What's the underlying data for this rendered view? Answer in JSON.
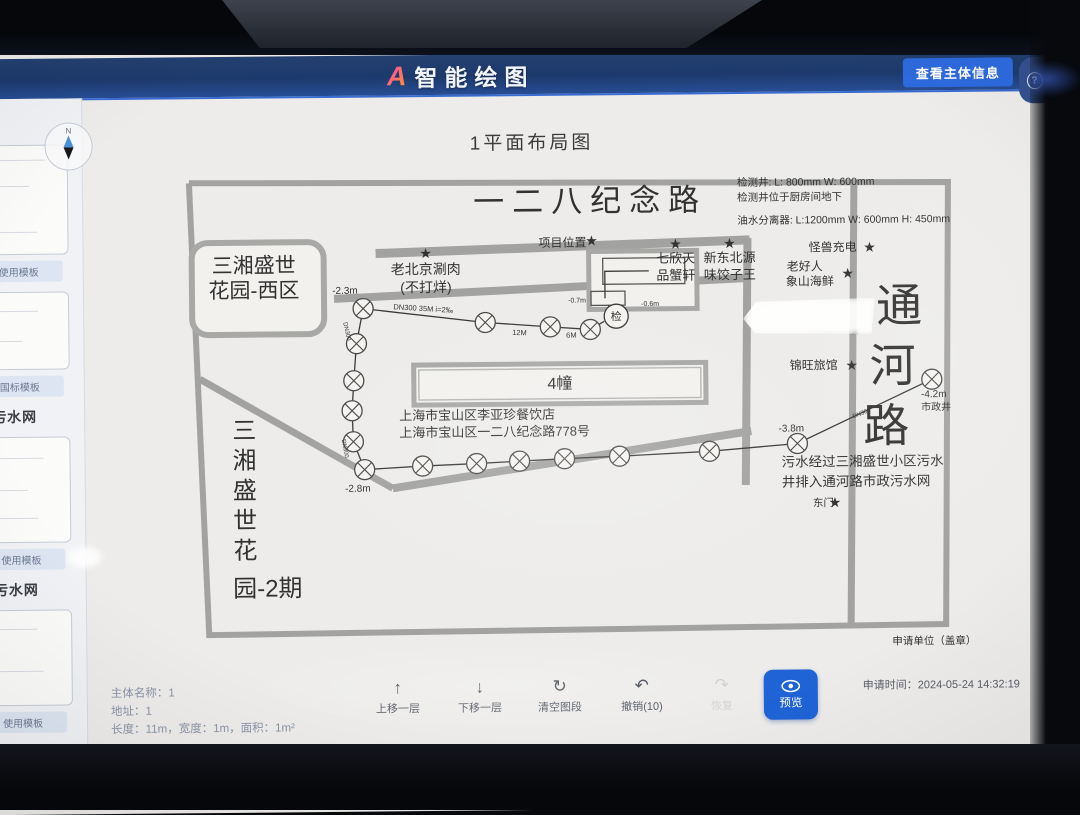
{
  "header": {
    "logo_mark": "A",
    "logo_text": "智能绘图",
    "view_subject_button": "查看主体信息",
    "help_icon": "?",
    "help_label": "帮助"
  },
  "sidebar": {
    "headings": [
      "污水网",
      "污水网"
    ],
    "cards": [
      {
        "button": "使用模板"
      },
      {
        "button": "国标模板"
      },
      {
        "button": "使用模板"
      },
      {
        "button": "使用模板"
      }
    ]
  },
  "canvas": {
    "title": "1平面布局图",
    "compass": "N"
  },
  "colors": {
    "accent_blue": "#1f63d6",
    "header_blue": "#1d3a6d",
    "wall_gray": "#a2a2a0",
    "pipe_dark": "#3a3a3a"
  },
  "map": {
    "roads": [
      {
        "pts": [
          [
            197,
            180
          ],
          [
            956,
            186
          ],
          [
            950,
            628
          ],
          [
            213,
            632
          ],
          [
            197,
            180
          ]
        ],
        "w": 6
      },
      {
        "pts": [
          [
            383,
            252
          ],
          [
            757,
            242
          ]
        ],
        "w": 9
      },
      {
        "pts": [
          [
            341,
            297
          ],
          [
            757,
            280
          ]
        ],
        "w": 8
      },
      {
        "pts": [
          [
            206,
            376
          ],
          [
            398,
            487
          ]
        ],
        "w": 7
      },
      {
        "pts": [
          [
            398,
            487
          ],
          [
            757,
            433
          ]
        ],
        "w": 8
      },
      {
        "pts": [
          [
            755,
            240
          ],
          [
            751,
            487
          ]
        ],
        "w": 8
      },
      {
        "pts": [
          [
            862,
            183
          ],
          [
            855,
            626
          ]
        ],
        "w": 7
      }
    ],
    "buildings": [
      {
        "x": 420,
        "y": 364,
        "w": 292,
        "h": 40,
        "sw": 5,
        "inset": 5
      },
      {
        "x": 596,
        "y": 252,
        "w": 108,
        "h": 58,
        "sw": 5
      },
      {
        "x": 610,
        "y": 259,
        "w": 82,
        "h": 26,
        "sw": 1.3,
        "thin": true
      },
      {
        "x": 598,
        "y": 292,
        "w": 34,
        "h": 14,
        "sw": 1.3,
        "thin": true
      },
      {
        "x": 199,
        "y": 240,
        "w": 132,
        "h": 92,
        "sw": 6,
        "rx": 16
      }
    ],
    "pipes": [
      [
        [
          370,
          307
        ],
        [
          492,
          322
        ],
        [
          557,
          327
        ],
        [
          597,
          330
        ],
        [
          611,
          322
        ]
      ],
      [
        [
          615,
          306
        ],
        [
          623,
          317
        ]
      ],
      [
        [
          612,
          299
        ],
        [
          612,
          272
        ],
        [
          656,
          272
        ]
      ],
      [
        [
          370,
          307
        ],
        [
          363,
          342
        ],
        [
          360,
          379
        ],
        [
          358,
          409
        ],
        [
          359,
          440
        ],
        [
          370,
          468
        ]
      ],
      [
        [
          370,
          468
        ],
        [
          428,
          465
        ],
        [
          482,
          463
        ],
        [
          525,
          461
        ],
        [
          570,
          459
        ],
        [
          625,
          457
        ],
        [
          715,
          453
        ],
        [
          803,
          446
        ],
        [
          938,
          383
        ]
      ]
    ],
    "manholes": [
      [
        370,
        307
      ],
      [
        492,
        322
      ],
      [
        557,
        327
      ],
      [
        597,
        330
      ],
      [
        363,
        342
      ],
      [
        360,
        379
      ],
      [
        358,
        409
      ],
      [
        359,
        440
      ],
      [
        370,
        468
      ],
      [
        428,
        465
      ],
      [
        482,
        463
      ],
      [
        525,
        461
      ],
      [
        570,
        459
      ],
      [
        625,
        457
      ],
      [
        715,
        453
      ],
      [
        803,
        446
      ],
      [
        938,
        383
      ]
    ],
    "inspection_well": {
      "x": 623,
      "y": 317,
      "label": "检"
    },
    "stars": [
      {
        "x": 599,
        "y": 241
      },
      {
        "x": 433,
        "y": 252
      },
      {
        "x": 683,
        "y": 245
      },
      {
        "x": 737,
        "y": 245
      },
      {
        "x": 877,
        "y": 250
      },
      {
        "x": 855,
        "y": 276
      },
      {
        "x": 858,
        "y": 368
      },
      {
        "x": 840,
        "y": 505
      },
      {
        "x": 862,
        "y": 333,
        "faint": true
      }
    ],
    "labels": [
      {
        "t": "一二八纪念路",
        "x": 598,
        "y": 212,
        "s": 31,
        "ls": 8,
        "c": "#2e2e2e"
      },
      {
        "t": "检测井: L: 800mm W: 600mm",
        "x": 745,
        "y": 188,
        "s": 10.5,
        "a": "start",
        "c": "#4a4a4a"
      },
      {
        "t": "检测井位于厨房间地下",
        "x": 745,
        "y": 203,
        "s": 10.5,
        "a": "start",
        "c": "#4a4a4a"
      },
      {
        "t": "油水分离器: L:1200mm W: 600mm H: 450mm",
        "x": 745,
        "y": 226,
        "s": 10.5,
        "a": "start",
        "c": "#4a4a4a"
      },
      {
        "t": "项目位置",
        "x": 570,
        "y": 247,
        "s": 12
      },
      {
        "t": "老北京涮肉",
        "x": 433,
        "y": 273,
        "s": 14
      },
      {
        "t": "(不打烊)",
        "x": 433,
        "y": 291,
        "s": 14
      },
      {
        "t": "七欣天",
        "x": 683,
        "y": 264,
        "s": 13
      },
      {
        "t": "品蟹轩",
        "x": 683,
        "y": 281,
        "s": 13
      },
      {
        "t": "新东北源",
        "x": 737,
        "y": 264,
        "s": 13
      },
      {
        "t": "味饺子王",
        "x": 737,
        "y": 281,
        "s": 13
      },
      {
        "t": "怪兽充电",
        "x": 840,
        "y": 254,
        "s": 12
      },
      {
        "t": "老好人",
        "x": 812,
        "y": 273,
        "s": 12
      },
      {
        "t": "象山海鲜",
        "x": 817,
        "y": 288,
        "s": 12
      },
      {
        "t": "锦旺旅馆",
        "x": 820,
        "y": 372,
        "s": 12
      },
      {
        "t": "通",
        "x": 906,
        "y": 325,
        "s": 46
      },
      {
        "t": "河",
        "x": 899,
        "y": 385,
        "s": 46
      },
      {
        "t": "路",
        "x": 892,
        "y": 445,
        "s": 46
      },
      {
        "t": "-4.2m",
        "x": 927,
        "y": 401,
        "s": 10,
        "a": "start"
      },
      {
        "t": "市政井",
        "x": 927,
        "y": 414,
        "s": 10,
        "a": "start"
      },
      {
        "t": "-2.3m",
        "x": 352,
        "y": 292,
        "s": 10
      },
      {
        "t": "DN300 35M i=2‰",
        "x": 430,
        "y": 310,
        "s": 7.5,
        "r": 4
      },
      {
        "t": "12M",
        "x": 526,
        "y": 335,
        "s": 7.5,
        "r": 3
      },
      {
        "t": "6M",
        "x": 578,
        "y": 338,
        "s": 7.5
      },
      {
        "t": "-0.7m",
        "x": 584,
        "y": 303,
        "s": 7
      },
      {
        "t": "-0.6m",
        "x": 657,
        "y": 307,
        "s": 7
      },
      {
        "t": "-2.8m",
        "x": 363,
        "y": 490,
        "s": 10
      },
      {
        "t": "-3.8m",
        "x": 797,
        "y": 434,
        "s": 10
      },
      {
        "t": "4幢",
        "x": 566,
        "y": 389,
        "s": 16
      },
      {
        "t": "上海市宝山区李亚珍餐饮店",
        "x": 405,
        "y": 419,
        "s": 13,
        "a": "start"
      },
      {
        "t": "上海市宝山区一二八纪念路778号",
        "x": 405,
        "y": 436,
        "s": 13,
        "a": "start"
      },
      {
        "t": "三湘盛世",
        "x": 261,
        "y": 270,
        "s": 21
      },
      {
        "t": "花园-西区",
        "x": 261,
        "y": 295,
        "s": 21
      },
      {
        "t": "三",
        "x": 250,
        "y": 436,
        "s": 24
      },
      {
        "t": "湘",
        "x": 250,
        "y": 466,
        "s": 24
      },
      {
        "t": "盛",
        "x": 250,
        "y": 496,
        "s": 24
      },
      {
        "t": "世",
        "x": 250,
        "y": 526,
        "s": 24
      },
      {
        "t": "花",
        "x": 250,
        "y": 556,
        "s": 24
      },
      {
        "t": "园-2期",
        "x": 272,
        "y": 594,
        "s": 24
      },
      {
        "t": "污水经过三湘盛世小区污水",
        "x": 787,
        "y": 469,
        "s": 13.5,
        "a": "start"
      },
      {
        "t": "井排入通河路市政污水网",
        "x": 787,
        "y": 489,
        "s": 13.5,
        "a": "start"
      },
      {
        "t": "东门",
        "x": 818,
        "y": 509,
        "s": 10.5,
        "a": "start"
      },
      {
        "t": "申请单位（盖章）",
        "x": 896,
        "y": 648,
        "s": 10.5,
        "a": "start",
        "c": "#4a4a4a"
      },
      {
        "t": "DN300",
        "x": 352,
        "y": 330,
        "s": 6,
        "r": 78,
        "c": "#858585"
      },
      {
        "t": "DN300",
        "x": 349,
        "y": 447,
        "s": 6,
        "r": 80,
        "c": "#858585"
      },
      {
        "t": "DN300",
        "x": 868,
        "y": 418,
        "s": 6,
        "r": -21,
        "c": "#858585"
      }
    ]
  },
  "footer": {
    "info": {
      "name_line": "主体名称：1",
      "address_line": "地址：1",
      "dims_line": "长度：11m，宽度：1m，面积：1m²"
    },
    "tools": [
      {
        "icon": "↑",
        "label": "上移一层"
      },
      {
        "icon": "↓",
        "label": "下移一层"
      },
      {
        "icon": "↻",
        "label": "清空图段"
      },
      {
        "icon": "↶",
        "label": "撤销(10)"
      },
      {
        "icon": "↷",
        "label": "恢复"
      }
    ],
    "preview_button": "预览",
    "apply_time": "申请时间：2024-05-24 14:32:19"
  }
}
